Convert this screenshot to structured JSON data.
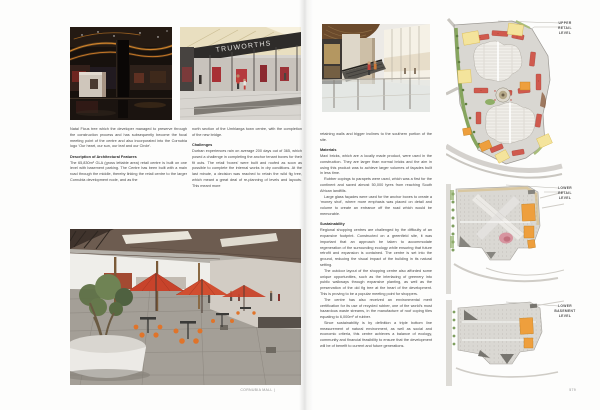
{
  "palette": {
    "umbrella_red": "#c8432b",
    "accent_red": "#b03238",
    "plan_yellow": "#f4e49c",
    "plan_orange": "#ee9f3d",
    "plan_shop_red": "#d05a4e",
    "plan_green": "#7e9d58",
    "plan_gray": "#d9d7d2",
    "fascia_black": "#2e2c2a"
  },
  "left_page": {
    "storefront_sign": "TRUWORTHS",
    "col1": {
      "p1": "Natal Ficus tree which the developer managed to preserve through the construction process and has subsequently become the focal meeting point of the centre and also incorporated into the Cornubia logo ‘Our heart, our sun, our leaf and our Circle’.",
      "h1": "Description of Architectural Features",
      "p2": "The 65,830m² GLA (gross lettable area) retail centre is built on one level with basement parking. The Centre has been built with a main road through the middle, thereby linking the retail centre to the larger Cornubia development node, and as the"
    },
    "col2": {
      "p1": "north section of the Umhlanga town centre, with the completion of the new bridge.",
      "h1": "Challenges",
      "p2": "Durban experiences rain on average 200 days out of 365, which posed a challenge in completing the anchor tenant boxes for their fit outs. The retail ‘boxes’ were built and roofed as soon as possible to complete the internal works in dry conditions. At the last minute, a decision was reached to retain the wild fig tree, which meant a great deal of re-planning of levels and layouts. This meant more"
    },
    "footer_running_title": "CORNUBIA MALL |"
  },
  "right_page": {
    "col": {
      "p0": "retaining walls and bigger inclines to the southern portion of the site.",
      "h_materials": "Materials",
      "m1": "Maxi bricks, which are a locally made product, were used in the construction. They are larger than normal bricks and the aim in using this product was to achieve larger volumes of façades built in less time.",
      "m2": "Rubber copings to parapets were used, which was a first for the continent and saved almost 50,000 tyres from reaching South African landfills.",
      "m3": "Large glass façades were used for the anchor boxes to create a ‘money shot’, where more emphasis was placed on detail and volume to create an entrance off the road which would be memorable.",
      "h_sustainability": "Sustainability",
      "s1": "Regional shopping centres are challenged by the difficulty of an expansive footprint. Constructed on a greenfield site, it was important that an approach be taken to accommodate regeneration of the surrounding ecology while ensuring that future retrofit and expansion is contained. The centre is set into the ground, reducing the visual impact of the building in its natural setting.",
      "s2": "The outdoor layout of the shopping centre also afforded some unique opportunities, such as the interlacing of greenery into public walkways through expansive planting, as well as the preservation of the old fig tree at the heart of the development. This is proving to be a popular meeting point for shoppers.",
      "s3": "The centre has also received an environmental merit certification for its use of recycled rubber, one of the world’s most hazardous waste streams, in the manufacture of roof coping tiles equating to 6,000m² of rubber.",
      "s4": "Since sustainability is by definition a triple bottom line measurement of natural environment, as well as social and economic criteria, this centre achieves a balance of ecology, community and financial feasibility to ensure that the development will be of benefit to current and future generations."
    },
    "plans": [
      {
        "label_lines": [
          "UPPER",
          "RETAIL",
          "LEVEL"
        ]
      },
      {
        "label_lines": [
          "LOWER",
          "RETAIL",
          "LEVEL"
        ]
      },
      {
        "label_lines": [
          "LOWER",
          "BASEMENT",
          "LEVEL"
        ]
      }
    ],
    "page_number": "579"
  }
}
